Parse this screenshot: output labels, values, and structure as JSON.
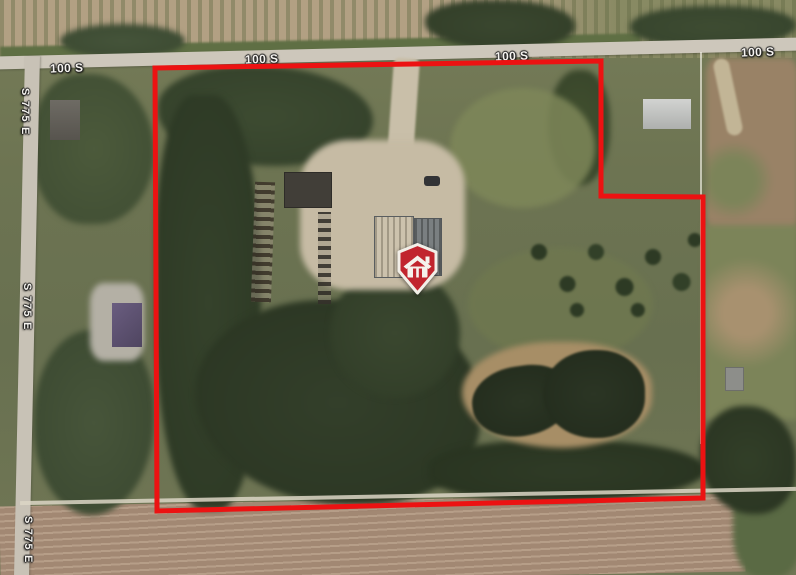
{
  "map": {
    "view_type": "satellite",
    "road_labels": [
      {
        "text": "100 S"
      },
      {
        "text": "100 S"
      },
      {
        "text": "100 S"
      },
      {
        "text": "100 S"
      },
      {
        "text": "S 775 E"
      },
      {
        "text": "S 775 E"
      },
      {
        "text": "S 775 E"
      }
    ],
    "boundary": {
      "points": "155,68 601,61 601,196 703,197 703,498 157,511",
      "color": "#ec1212"
    },
    "marker": {
      "icon": "house-icon",
      "pin_color": "#c1252e",
      "pin_border_color": "#f2efe8"
    }
  }
}
